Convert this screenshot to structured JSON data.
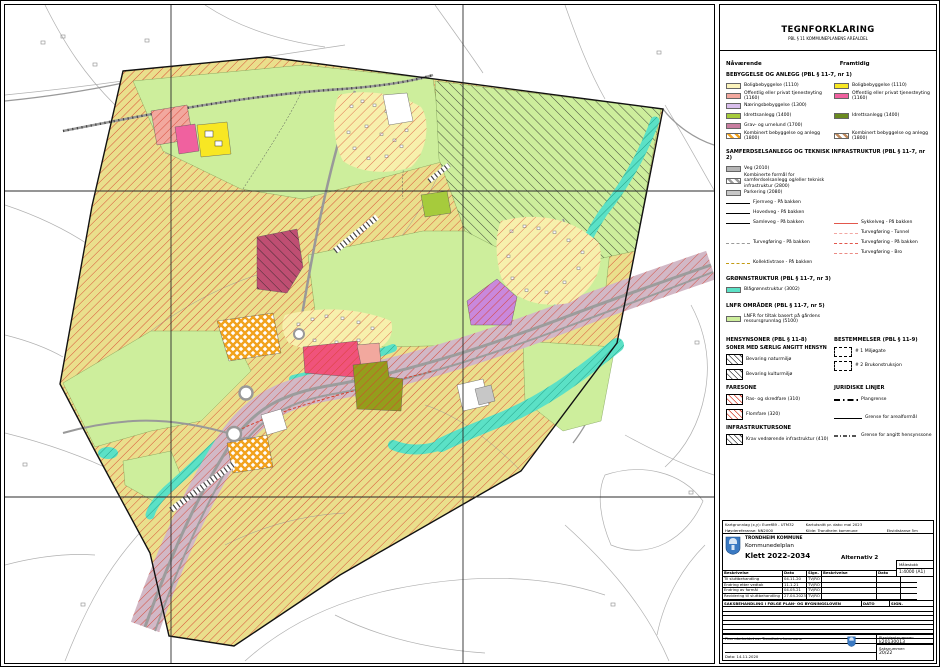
{
  "colors": {
    "plan_yellow": "#EADF8C",
    "lnfr": "#CDEE9C",
    "teal": "#5BE1C6",
    "corridor": "#D2B8C6",
    "village": "#F7F0AC",
    "hatch_red": "#D6402E",
    "bolig_now": "#FBF3BC",
    "bolig_future": "#F8E723",
    "offentlig_now": "#F2A89E",
    "offentlig_future": "#F0619F",
    "naering": "#D9BEEC",
    "idrett_now": "#A6CB3C",
    "idrett_future": "#6A8A1F",
    "grav": "#C87EA0",
    "veg": "#B5B5B5",
    "parkering": "#C7C7C7",
    "blaagronn": "#5BE1C6",
    "pink_area": "#F0537B",
    "crimson": "#BF4E72",
    "olive": "#949D1C",
    "purple": "#C988DC",
    "magenta": "#F0619F",
    "bright_yellow": "#F8E723",
    "salmon": "#F2A89E"
  },
  "legend": {
    "title": "TEGNFORKLARING",
    "subtitle": "PBL § 11 KOMMUNEPLANENS AREALDEL",
    "now": "Nåværende",
    "future": "Framtidig",
    "sec1": {
      "heading": "BEBYGGELSE OG ANLEGG (PBL § 11-7, nr 1)",
      "now": [
        "Boligbebyggelse (1110)",
        "Offentlig eller privat tjenesteyting (1160)",
        "Næringsbebyggelse (1300)",
        "Idrettsanlegg (1400)",
        "Grav- og urnelund (1700)",
        "Kombinert bebyggelse og anlegg (1800)"
      ],
      "future": [
        "Boligbebyggelse (1110)",
        "Offentlig eller privat tjenesteyting (1160)",
        "Idrettsanlegg (1400)",
        "Kombinert bebyggelse og anlegg (1800)"
      ]
    },
    "sec2": {
      "heading": "SAMFERDSELSANLEGG OG TEKNISK INFRASTRUKTUR (PBL § 11-7, nr 2)",
      "veg": "Veg (2010)",
      "komb": "Kombinerte formål for samferdselsanlegg og/eller teknisk infrastruktur (2800)",
      "parkering": "Parkering (2080)",
      "fjernveg": "Fjernveg - På bakken",
      "hovedveg": "Hovedveg - På bakken",
      "samleveg": "Samleveg - På bakken",
      "sykkelveg": "Sykkelveg - På bakken",
      "turveg_tunnel": "Turvegføring - Tunnel",
      "turveg_bakken_f": "Turvegføring - På bakken",
      "turveg_bro": "Turvegføring - Bro",
      "turveg_bakken_n": "Turvegføring - På bakken",
      "kollektiv": "Kollektivtrase - På bakken"
    },
    "sec3": {
      "heading": "GRØNNSTRUKTUR (PBL § 11-7, nr 3)",
      "item": "Blågrønnstruktur (3002)"
    },
    "sec4": {
      "heading": "LNFR OMRÅDER (PBL § 11-7, nr 5)",
      "item": "LNFR for tiltak basert på gårdens ressursgrunnlag (5100)"
    },
    "sec5": {
      "heading": "HENSYNSONER (PBL § 11-8)",
      "sub": "SONER MED SÆRLIG ANGITT HENSYN",
      "items": [
        "Bevaring naturmiljø",
        "Bevaring kulturmiljø"
      ]
    },
    "sec6": {
      "heading": "FARESONE",
      "items": [
        "Ras- og skredfare (310)",
        "Flomfare (320)"
      ]
    },
    "sec7": {
      "heading": "INFRASTRUKTURSONE",
      "item": "Krav vedrørende infrastruktur (410)"
    },
    "sec8": {
      "heading": "BESTEMMELSER (PBL § 11-9)",
      "items": [
        "# 1 Miljøgate",
        "# 2 Brukonstruksjon"
      ]
    },
    "sec9": {
      "heading": "JURIDISKE LINJER",
      "items": [
        "Plangrense",
        "Grense for arealformål",
        "Grense for angitt hensynssone"
      ]
    }
  },
  "titleblock": {
    "map_basis": "Kartgrunnlag (x,y): Euref89 - UTM32",
    "height_ref": "Høydereferanse: NN2000",
    "map_date": "Kartutsnitt pr. dato: mai 2023",
    "source": "Kilde: Trondheim kommune",
    "equidistance": "Ekvidistanse 5m",
    "municipality": "TRONDHEIM KOMMUNE",
    "plan_type": "Kommunedelplan",
    "plan_name": "Klett 2022-2034",
    "alternative": "Alternativ 2",
    "scale_label": "Målestokk",
    "scale": "1:4000 (A1)",
    "rev_headers": [
      "Beskrivelse",
      "Dato",
      "Sign."
    ],
    "revisions": [
      [
        "Til sluttbehandling",
        "04.11.20",
        "TV/RO"
      ],
      [
        "Endring etter vedtak",
        "11.1.21",
        "TV/RO"
      ],
      [
        "Endring av formål",
        "04.05.21",
        "TV/RO"
      ],
      [
        "Revidering til sluttbehandling",
        "27.04.2023",
        "TV/RO"
      ]
    ],
    "case_heading": "SAKSBEHANDLING I FØLGE PLAN- OG BYGNINGSLOVEN",
    "case_date": "DATO",
    "case_sign": "SIGN.",
    "prepared_by": "Plan utarbeidet av:   Trondheim kommune",
    "date": "Dato: 14.11.2020",
    "planid_label": "Planidentnummer:",
    "planid": "k20130013",
    "case_label": "Saksnummer:",
    "case_no": "20/22"
  }
}
